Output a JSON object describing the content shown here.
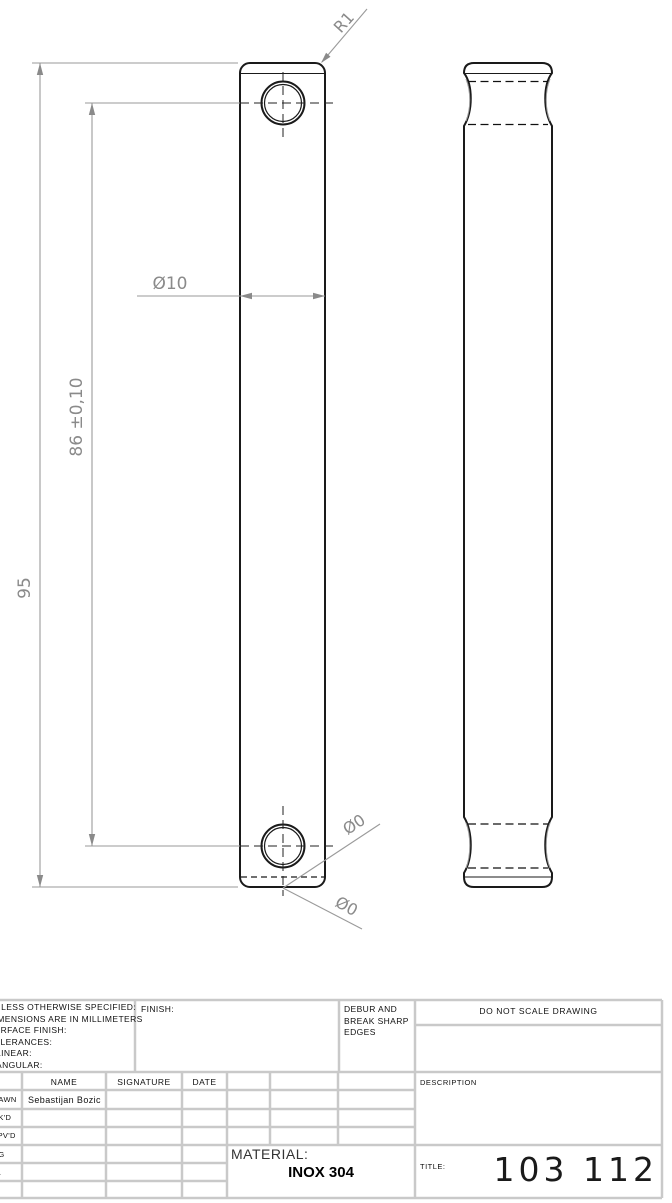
{
  "drawing": {
    "dimensions": {
      "corner_radius": "R1",
      "width_dia": "Ø10",
      "hole_spacing": "86 ±0,10",
      "overall_length": "95",
      "dia_callout_upper": "Ø0",
      "dia_callout_lower": "Ø0"
    },
    "colors": {
      "edge_line": "#1a1a1a",
      "dimension": "#8a8a8a",
      "grid_line": "#c9c9c9"
    }
  },
  "title_block": {
    "tolerance_note": {
      "line1": "UNLESS OTHERWISE SPECIFIED:",
      "line2": "DIMENSIONS ARE IN MILLIMETERS",
      "line3": "SURFACE FINISH:",
      "line4": "TOLERANCES:",
      "line5": "LINEAR:",
      "line6": "ANGULAR:"
    },
    "finish_label": "FINISH:",
    "debur_note": {
      "line1": "DEBUR AND",
      "line2": "BREAK SHARP",
      "line3": "EDGES"
    },
    "do_not_scale": "DO NOT SCALE DRAWING",
    "columns": {
      "name": "NAME",
      "signature": "SIGNATURE",
      "date": "DATE"
    },
    "rows": {
      "drawn": "DRAWN",
      "chkd": "CHK'D",
      "appvd": "APPV'D",
      "mfg": "MFG",
      "qa": "Q.A"
    },
    "drawn_name": "Sebastijan Bozic",
    "description_label": "DESCRIPTION",
    "material_label": "MATERIAL:",
    "material_value": "INOX 304",
    "title_label": "TITLE:",
    "title_value": "103 112"
  }
}
